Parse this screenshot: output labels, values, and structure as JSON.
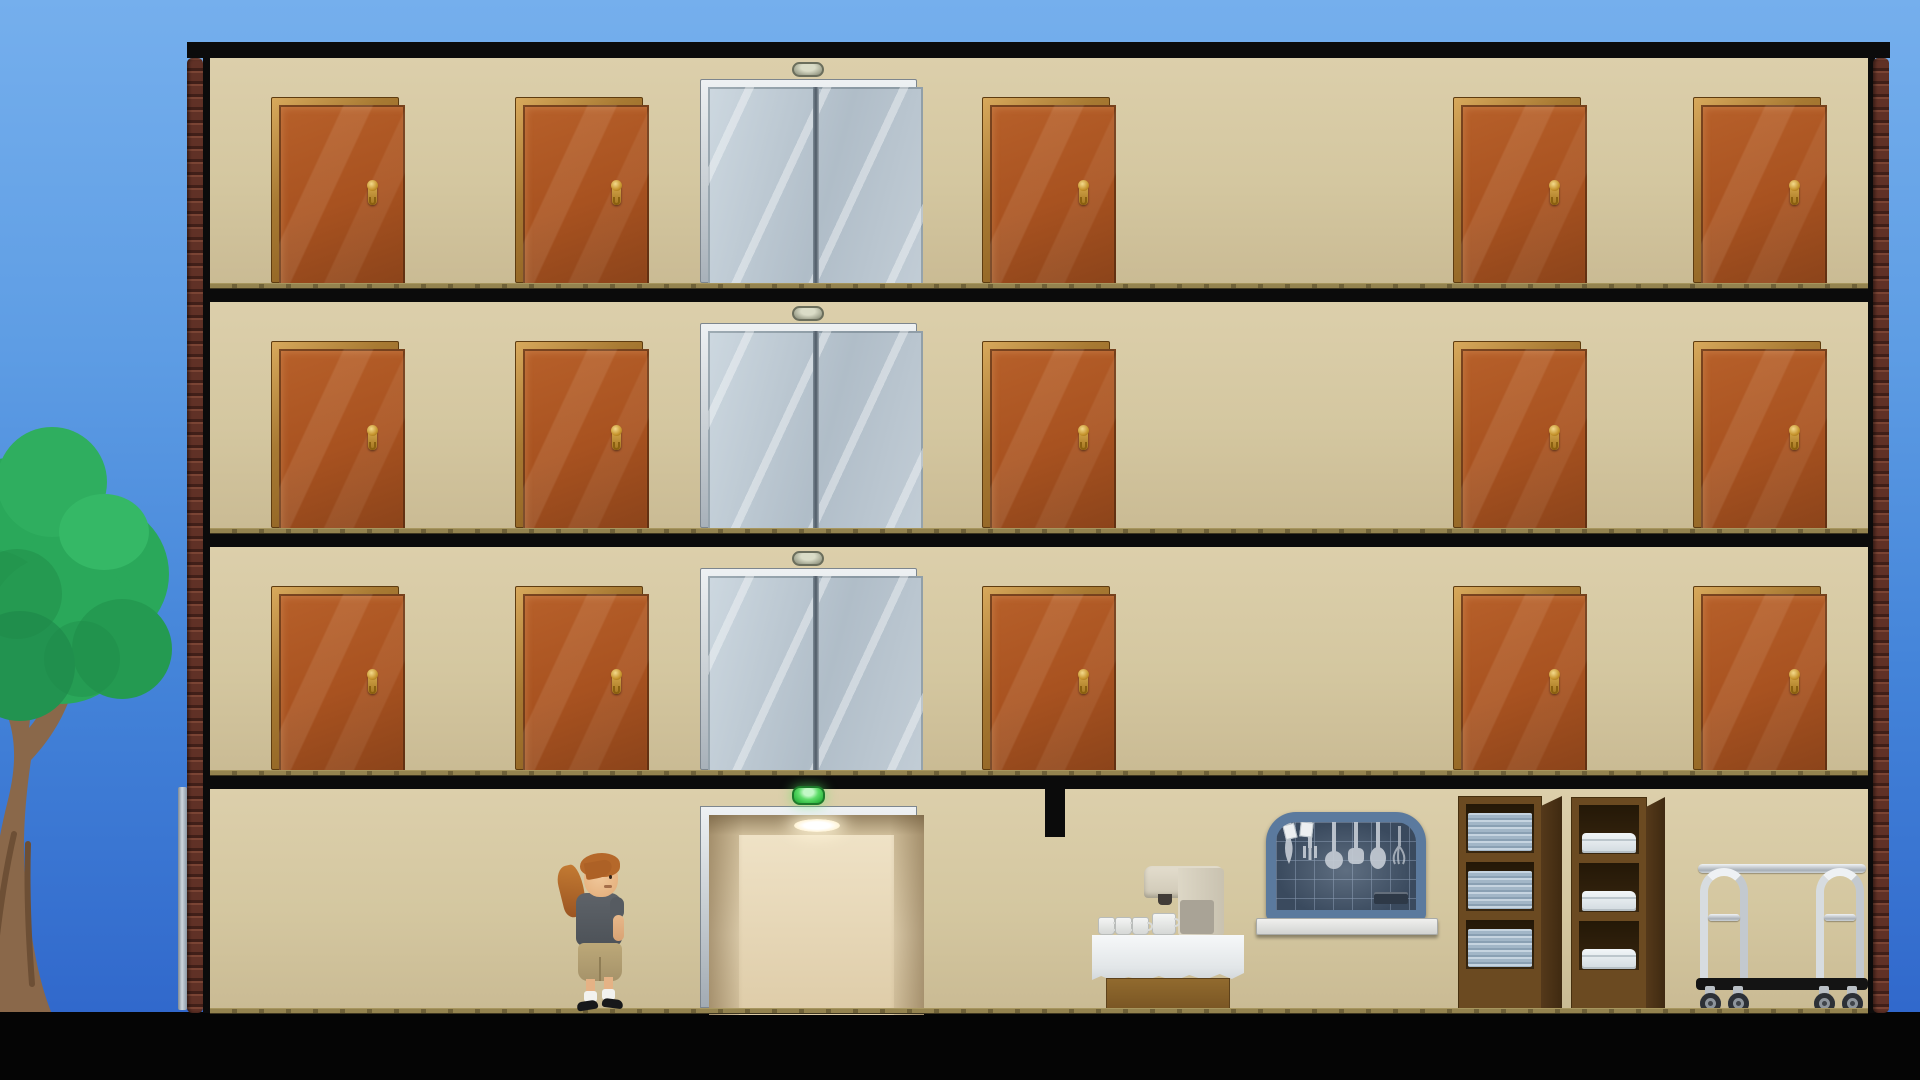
{
  "scene": {
    "game": "hotel-building-simulation",
    "canvas": {
      "width": 1920,
      "height": 1080
    },
    "colors": {
      "sky-top": "#75afed",
      "sky-bottom": "#2d63c9",
      "wall": "#d4c7a0",
      "structure-black": "#0b0b0b",
      "ledge-olive": "#87784a",
      "brick": "#603126",
      "door-panel": "#a85220",
      "door-frame": "#a87a33",
      "handle-gold": "#c6942d",
      "elevator-door": "#bcc9d3",
      "elevator-frame": "#c8d0d6",
      "indicator-idle": "#a9ac97",
      "indicator-green": "#3fca52",
      "elevator-interior": "#e6d8ba",
      "carpet": "#7d6e3f",
      "wood": "#6b4a21",
      "towel-blue": "#a2b6c7",
      "sheet-white": "#e8eef2",
      "rack-steel": "#5b7a9e",
      "chrome": "#c3c9cf",
      "tree-green": "#2aa85a",
      "trunk-brown": "#8a684a",
      "cloth-white": "#eceff1",
      "machine-cream": "#d8d2c2"
    },
    "ground": {
      "black_top": 1012
    },
    "tree": {
      "rect": [
        -38,
        424,
        230,
        590
      ]
    },
    "building": {
      "left": 187,
      "right": 1890,
      "top": 42,
      "bottom": 1013,
      "wall_left": 210,
      "wall_right": 1868,
      "roof_h": 16,
      "brick_w": 16,
      "border_w": 7,
      "downspout": [
        178,
        787,
        9,
        223
      ]
    },
    "door_slots": [
      271,
      515,
      982,
      1453,
      1693
    ],
    "door": {
      "width": 128,
      "top_offset": 39,
      "handle": {
        "right_frac": 0.76,
        "top_frac": 0.4
      }
    },
    "elevator": {
      "x": 700,
      "width": 217,
      "top_offset": 21,
      "indicator_cx": 808,
      "indicator_top_offset": 4
    },
    "floors": [
      {
        "id": "floor-3",
        "wall_top": 58,
        "floor_y": 283,
        "rooms": 5,
        "elevator_state": "closed"
      },
      {
        "id": "floor-2",
        "wall_top": 302,
        "floor_y": 528,
        "rooms": 5,
        "elevator_state": "closed"
      },
      {
        "id": "floor-1",
        "wall_top": 547,
        "floor_y": 770,
        "rooms": 5,
        "elevator_state": "closed"
      }
    ],
    "ground_floor": {
      "id": "lobby",
      "wall_top": 789,
      "floor_y": 1008,
      "carpet": [
        210,
        1008,
        1658,
        6
      ],
      "elevator_open": {
        "rect": [
          700,
          806,
          217,
          202
        ],
        "state": "open"
      },
      "indicator_green": {
        "rect": [
          792,
          786,
          33,
          19
        ],
        "status": "arrived"
      },
      "wall_stub": [
        1045,
        789,
        20,
        48
      ],
      "character": {
        "rect": [
          560,
          853,
          72,
          157
        ],
        "role": "housekeeper",
        "facing": "right",
        "hair": "auburn-ponytail",
        "shirt": "dark-gray",
        "shorts": "khaki"
      },
      "service_table": {
        "rect": [
          1092,
          866,
          152,
          144
        ],
        "mugs_on_table": 3,
        "mug_under_spout": 1,
        "appliance": "coffee-machine"
      },
      "utensil_rack": {
        "rect": [
          1266,
          812,
          160,
          108
        ],
        "sill": [
          1256,
          918,
          182,
          17
        ],
        "utensils": [
          "knife",
          "fork",
          "ladle",
          "spatula",
          "spoon",
          "whisk"
        ],
        "cards": 2
      },
      "towel_shelf": {
        "rect": [
          1458,
          796,
          84,
          214
        ],
        "side_w": 20,
        "compartments": 3,
        "fill": "towel-stacks"
      },
      "sheet_shelf": {
        "rect": [
          1571,
          797,
          76,
          213
        ],
        "side_w": 18,
        "compartments": 3,
        "fill": "folded-sheets"
      },
      "luggage_cart": {
        "rect": [
          1696,
          862,
          172,
          152
        ],
        "wheels": 4
      }
    }
  }
}
